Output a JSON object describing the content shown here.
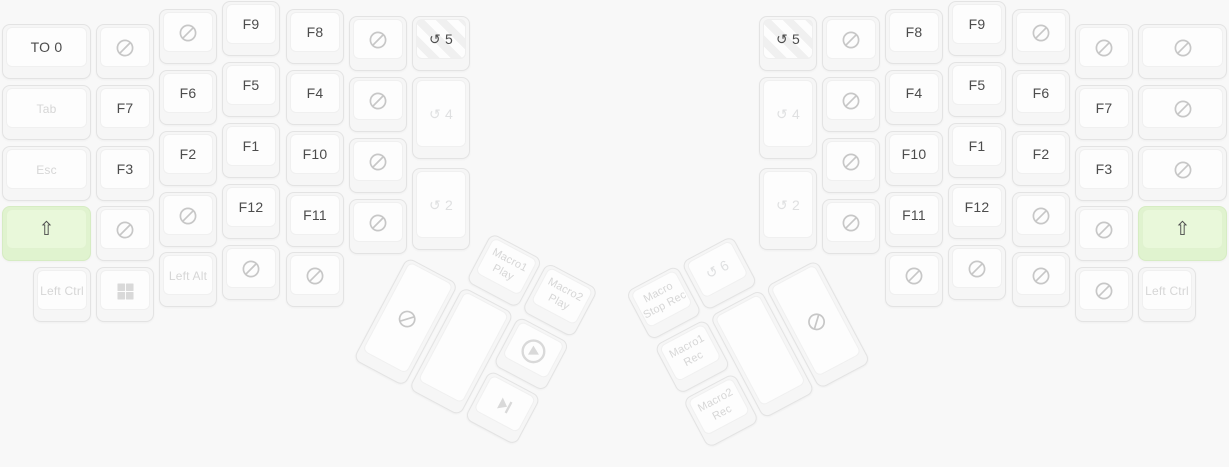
{
  "colors": {
    "background": "#f8f8f8",
    "key_base": "#f6f6f6",
    "key_face": "#fdfdfd",
    "key_border": "#e3e3e3",
    "text_active": "#4c4c4c",
    "text_muted": "#d6d6d6",
    "text_faint": "#dfe0e1",
    "icon_none": "#c7c7c7",
    "icon_media": "#d9d9d9",
    "green_base": "#e0f3cf",
    "green_face": "#e9f8da",
    "green_border": "#d6ecc3",
    "stripe_light": "#fdfdfd",
    "stripe_dark": "#f0f0f0"
  },
  "keyboard": {
    "main_keys": [
      {
        "name": "key-to-0",
        "x": 2,
        "y": 24,
        "w": 89,
        "lines": [
          "TO 0"
        ],
        "variant": "active"
      },
      {
        "name": "key-tab",
        "x": 2,
        "y": 85,
        "w": 89,
        "lines": [
          "Tab"
        ],
        "variant": "muted",
        "fs": 12
      },
      {
        "name": "key-esc",
        "x": 2,
        "y": 146,
        "w": 89,
        "lines": [
          "Esc"
        ],
        "variant": "muted",
        "fs": 12
      },
      {
        "name": "key-left-shift",
        "x": 2,
        "y": 206,
        "w": 89,
        "lines": [
          "⇧"
        ],
        "variant": "green",
        "fs": 19
      },
      {
        "name": "key-none",
        "x": 96,
        "y": 24,
        "icon": "none"
      },
      {
        "name": "key-f7",
        "x": 96,
        "y": 85,
        "lines": [
          "F7"
        ]
      },
      {
        "name": "key-f3",
        "x": 96,
        "y": 146,
        "lines": [
          "F3"
        ]
      },
      {
        "name": "key-none",
        "x": 96,
        "y": 206,
        "icon": "none"
      },
      {
        "name": "key-none",
        "x": 159,
        "y": 9,
        "icon": "none"
      },
      {
        "name": "key-f6",
        "x": 159,
        "y": 70,
        "lines": [
          "F6"
        ]
      },
      {
        "name": "key-f2",
        "x": 159,
        "y": 131,
        "lines": [
          "F2"
        ]
      },
      {
        "name": "key-none",
        "x": 159,
        "y": 192,
        "icon": "none"
      },
      {
        "name": "key-f9",
        "x": 222,
        "y": 1,
        "lines": [
          "F9"
        ]
      },
      {
        "name": "key-f5",
        "x": 222,
        "y": 62,
        "lines": [
          "F5"
        ]
      },
      {
        "name": "key-f1",
        "x": 222,
        "y": 123,
        "lines": [
          "F1"
        ]
      },
      {
        "name": "key-f12",
        "x": 222,
        "y": 184,
        "lines": [
          "F12"
        ]
      },
      {
        "name": "key-none",
        "x": 222,
        "y": 245,
        "icon": "none"
      },
      {
        "name": "key-f8",
        "x": 286,
        "y": 9,
        "lines": [
          "F8"
        ]
      },
      {
        "name": "key-f4",
        "x": 286,
        "y": 70,
        "lines": [
          "F4"
        ]
      },
      {
        "name": "key-f10",
        "x": 286,
        "y": 131,
        "lines": [
          "F10"
        ]
      },
      {
        "name": "key-f11",
        "x": 286,
        "y": 192,
        "lines": [
          "F11"
        ]
      },
      {
        "name": "key-none",
        "x": 286,
        "y": 252,
        "icon": "none"
      },
      {
        "name": "key-none",
        "x": 349,
        "y": 16,
        "icon": "none"
      },
      {
        "name": "key-none",
        "x": 349,
        "y": 77,
        "icon": "none"
      },
      {
        "name": "key-none",
        "x": 349,
        "y": 138,
        "icon": "none"
      },
      {
        "name": "key-none",
        "x": 349,
        "y": 199,
        "icon": "none"
      },
      {
        "name": "key-layer-5",
        "x": 412,
        "y": 16,
        "lines": [
          "↺ 5"
        ],
        "variant": "striped"
      },
      {
        "name": "key-layer-4",
        "x": 412,
        "y": 77,
        "h": 82,
        "lines": [
          "↺ 4"
        ],
        "variant": "faint"
      },
      {
        "name": "key-layer-2",
        "x": 412,
        "y": 168,
        "h": 82,
        "lines": [
          "↺ 2"
        ],
        "variant": "faint"
      },
      {
        "name": "key-left-ctrl",
        "x": 33,
        "y": 267,
        "lines": [
          "Left Ctrl"
        ],
        "variant": "muted",
        "fs": 12
      },
      {
        "name": "key-win",
        "x": 96,
        "y": 267,
        "icon": "win",
        "variant": "muted"
      },
      {
        "name": "key-left-alt",
        "x": 159,
        "y": 252,
        "lines": [
          "Left Alt"
        ],
        "variant": "muted",
        "fs": 12
      },
      {
        "name": "key-layer-5",
        "x": 759,
        "y": 16,
        "lines": [
          "↺ 5"
        ],
        "variant": "striped"
      },
      {
        "name": "key-layer-4",
        "x": 759,
        "y": 77,
        "h": 82,
        "lines": [
          "↺ 4"
        ],
        "variant": "faint"
      },
      {
        "name": "key-layer-2",
        "x": 759,
        "y": 168,
        "h": 82,
        "lines": [
          "↺ 2"
        ],
        "variant": "faint"
      },
      {
        "name": "key-none",
        "x": 822,
        "y": 16,
        "icon": "none"
      },
      {
        "name": "key-none",
        "x": 822,
        "y": 77,
        "icon": "none"
      },
      {
        "name": "key-none",
        "x": 822,
        "y": 138,
        "icon": "none"
      },
      {
        "name": "key-none",
        "x": 822,
        "y": 199,
        "icon": "none"
      },
      {
        "name": "key-f8",
        "x": 885,
        "y": 9,
        "lines": [
          "F8"
        ]
      },
      {
        "name": "key-f4",
        "x": 885,
        "y": 70,
        "lines": [
          "F4"
        ]
      },
      {
        "name": "key-f10",
        "x": 885,
        "y": 131,
        "lines": [
          "F10"
        ]
      },
      {
        "name": "key-f11",
        "x": 885,
        "y": 192,
        "lines": [
          "F11"
        ]
      },
      {
        "name": "key-none",
        "x": 885,
        "y": 252,
        "icon": "none"
      },
      {
        "name": "key-f9",
        "x": 948,
        "y": 1,
        "lines": [
          "F9"
        ]
      },
      {
        "name": "key-f5",
        "x": 948,
        "y": 62,
        "lines": [
          "F5"
        ]
      },
      {
        "name": "key-f1",
        "x": 948,
        "y": 123,
        "lines": [
          "F1"
        ]
      },
      {
        "name": "key-f12",
        "x": 948,
        "y": 184,
        "lines": [
          "F12"
        ]
      },
      {
        "name": "key-none",
        "x": 948,
        "y": 245,
        "icon": "none"
      },
      {
        "name": "key-none",
        "x": 1012,
        "y": 9,
        "icon": "none"
      },
      {
        "name": "key-f6",
        "x": 1012,
        "y": 70,
        "lines": [
          "F6"
        ]
      },
      {
        "name": "key-f2",
        "x": 1012,
        "y": 131,
        "lines": [
          "F2"
        ]
      },
      {
        "name": "key-none",
        "x": 1012,
        "y": 192,
        "icon": "none"
      },
      {
        "name": "key-none",
        "x": 1012,
        "y": 252,
        "icon": "none"
      },
      {
        "name": "key-none",
        "x": 1075,
        "y": 24,
        "icon": "none"
      },
      {
        "name": "key-f7",
        "x": 1075,
        "y": 85,
        "lines": [
          "F7"
        ]
      },
      {
        "name": "key-f3",
        "x": 1075,
        "y": 146,
        "lines": [
          "F3"
        ]
      },
      {
        "name": "key-none",
        "x": 1075,
        "y": 206,
        "icon": "none"
      },
      {
        "name": "key-none",
        "x": 1075,
        "y": 267,
        "icon": "none"
      },
      {
        "name": "key-none",
        "x": 1138,
        "y": 24,
        "w": 89,
        "icon": "none"
      },
      {
        "name": "key-none",
        "x": 1138,
        "y": 85,
        "w": 89,
        "icon": "none"
      },
      {
        "name": "key-none",
        "x": 1138,
        "y": 146,
        "w": 89,
        "icon": "none"
      },
      {
        "name": "key-right-shift",
        "x": 1138,
        "y": 206,
        "w": 89,
        "lines": [
          "⇧"
        ],
        "variant": "green",
        "fs": 19
      },
      {
        "name": "key-left-ctrl",
        "x": 1138,
        "y": 267,
        "lines": [
          "Left Ctrl"
        ],
        "variant": "muted",
        "fs": 12
      }
    ],
    "thumb_clusters": [
      {
        "id": "thumb-left",
        "name": "left-thumb-cluster",
        "rotation": 28,
        "keys": [
          {
            "name": "key-macro1-play",
            "x": 63,
            "y": 0,
            "lines": [
              "Macro1",
              "Play"
            ],
            "variant": "muted",
            "fs": 11
          },
          {
            "name": "key-macro2-play",
            "x": 126,
            "y": 0,
            "lines": [
              "Macro2",
              "Play"
            ],
            "variant": "muted",
            "fs": 11
          },
          {
            "name": "key-none",
            "x": 0,
            "y": 61,
            "h": 116,
            "icon": "none"
          },
          {
            "name": "key-blank",
            "x": 63,
            "y": 61,
            "h": 116
          },
          {
            "name": "key-play",
            "x": 126,
            "y": 61,
            "icon": "play-circle",
            "counter_rotate": true
          },
          {
            "name": "key-next-track",
            "x": 126,
            "y": 122,
            "icon": "next-track"
          }
        ]
      },
      {
        "id": "thumb-right",
        "name": "right-thumb-cluster",
        "rotation": -28,
        "keys": [
          {
            "name": "key-macro-stop-rec",
            "x": 0,
            "y": 0,
            "lines": [
              "Macro",
              "Stop Rec"
            ],
            "variant": "muted",
            "fs": 11
          },
          {
            "name": "key-layer-6",
            "x": 63,
            "y": 0,
            "lines": [
              "↺ 6"
            ],
            "variant": "faint"
          },
          {
            "name": "key-macro1-rec",
            "x": 0,
            "y": 61,
            "lines": [
              "Macro1",
              "Rec"
            ],
            "variant": "muted",
            "fs": 11
          },
          {
            "name": "key-macro2-rec",
            "x": 0,
            "y": 122,
            "lines": [
              "Macro2",
              "Rec"
            ],
            "variant": "muted",
            "fs": 11
          },
          {
            "name": "key-blank",
            "x": 63,
            "y": 61,
            "h": 116
          },
          {
            "name": "key-none",
            "x": 126,
            "y": 61,
            "h": 116,
            "icon": "none"
          }
        ]
      }
    ]
  }
}
